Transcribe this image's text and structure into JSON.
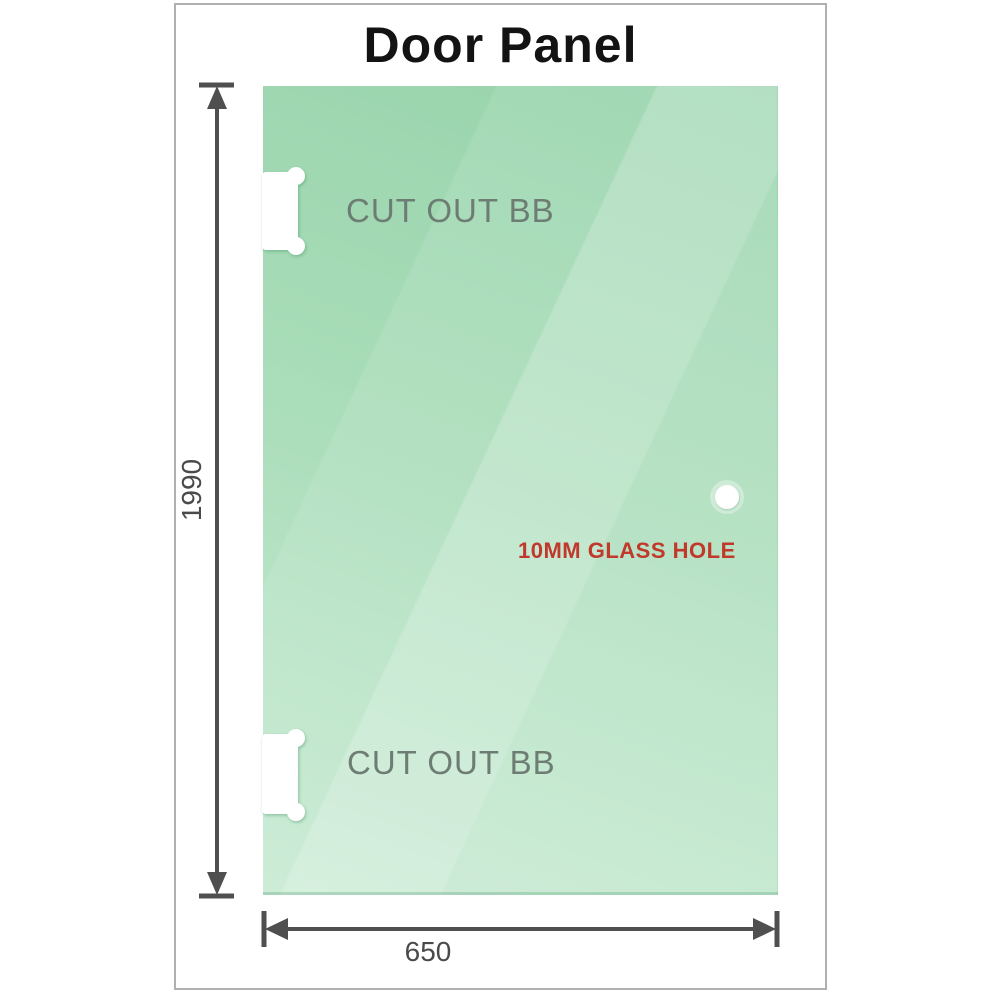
{
  "title": "Door Panel",
  "labels": {
    "cutout_top": "CUT OUT BB",
    "cutout_bottom": "CUT OUT BB",
    "glass_hole": "10MM GLASS HOLE"
  },
  "dimensions": {
    "height": "1990",
    "width": "650"
  },
  "colors": {
    "glass_base": "#96d3ab",
    "glass_mid": "#a8dcb8",
    "glass_light": "#c7ead2",
    "frame_border": "#b0b0b0",
    "dimension_line": "#4f4f4f",
    "dim_text": "#4a4a4a",
    "label_gray": "#6e7d74",
    "hole_red": "#c0392b",
    "title_color": "#131313"
  }
}
